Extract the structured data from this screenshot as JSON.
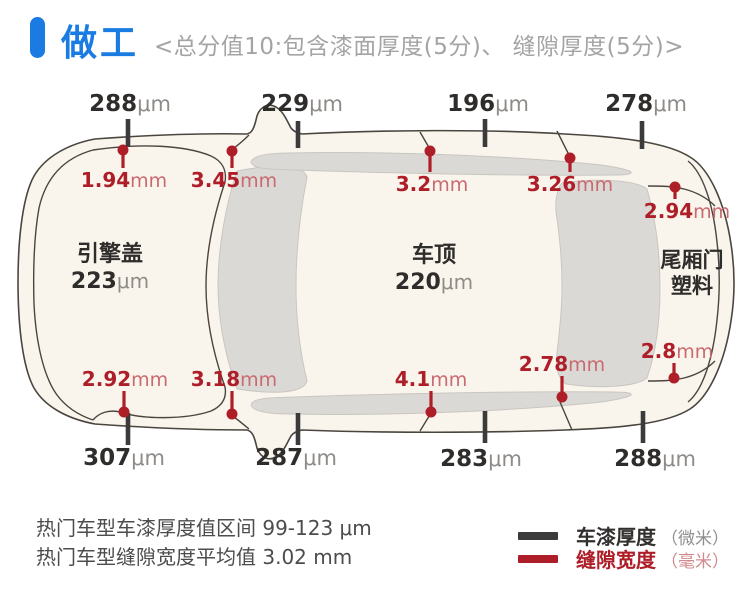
{
  "header": {
    "title": "做工",
    "subtitle": "<总分值10:包含漆面厚度(5分)、 缝隙厚度(5分)>"
  },
  "colors": {
    "accent_blue": "#1a7ce2",
    "gap_red": "#ae1e28",
    "paint_black": "#2f2d2b",
    "unit_gray": "#8e8b88",
    "car_fill": "#faf5ec",
    "glass_gray": "#dbd9d6",
    "outline": "#4a453f"
  },
  "car": {
    "panels": [
      {
        "label": "引擎盖",
        "value": "223",
        "unit": "μm"
      },
      {
        "label": "车顶",
        "value": "220",
        "unit": "μm"
      },
      {
        "label": "尾厢门",
        "label2": "塑料"
      }
    ],
    "paint_top": [
      {
        "value": "288",
        "unit": "μm"
      },
      {
        "value": "229",
        "unit": "μm"
      },
      {
        "value": "196",
        "unit": "μm"
      },
      {
        "value": "278",
        "unit": "μm"
      }
    ],
    "paint_bottom": [
      {
        "value": "307",
        "unit": "μm"
      },
      {
        "value": "287",
        "unit": "μm"
      },
      {
        "value": "283",
        "unit": "μm"
      },
      {
        "value": "288",
        "unit": "μm"
      }
    ],
    "gap_top": [
      {
        "value": "1.94",
        "unit": "mm"
      },
      {
        "value": "3.45",
        "unit": "mm"
      },
      {
        "value": "3.2",
        "unit": "mm"
      },
      {
        "value": "3.26",
        "unit": "mm"
      },
      {
        "value": "2.94",
        "unit": "mm"
      }
    ],
    "gap_bottom": [
      {
        "value": "2.92",
        "unit": "mm"
      },
      {
        "value": "3.18",
        "unit": "mm"
      },
      {
        "value": "4.1",
        "unit": "mm"
      },
      {
        "value": "2.78",
        "unit": "mm"
      },
      {
        "value": "2.8",
        "unit": "mm"
      }
    ]
  },
  "footer": {
    "note1": "热门车型车漆厚度值区间 99-123 μm",
    "note2": "热门车型缝隙宽度平均值 3.02 mm",
    "legend": [
      {
        "label": "车漆厚度",
        "unit": "（微米）",
        "color": "#3b3b3b"
      },
      {
        "label": "缝隙宽度",
        "unit": "（毫米）",
        "color": "#ae1e28"
      }
    ]
  }
}
